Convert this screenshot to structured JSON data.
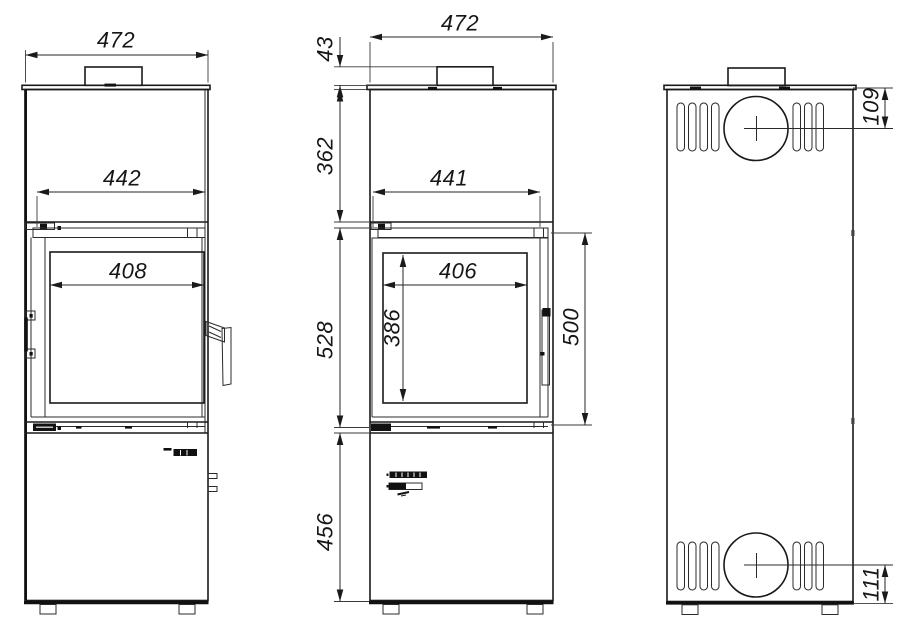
{
  "drawing": {
    "type": "technical-drawing",
    "subject": "wood stove three-view dimensional drawing",
    "background_color": "#ffffff",
    "line_color": "#1a1a1a",
    "views": {
      "left": {
        "label": "left-view",
        "dims": {
          "overall_width": "472",
          "door_width": "442",
          "glass_width": "408"
        }
      },
      "front": {
        "label": "front-view",
        "dims": {
          "overall_width": "472",
          "collar_height": "43",
          "upper_body_height": "362",
          "door_section_height": "528",
          "base_height": "456",
          "door_width": "441",
          "glass_width": "406",
          "glass_height": "386",
          "door_height": "500"
        }
      },
      "rear": {
        "label": "rear-view",
        "dims": {
          "flue_center_from_top": "109",
          "intake_center_from_bottom": "111"
        }
      }
    }
  }
}
